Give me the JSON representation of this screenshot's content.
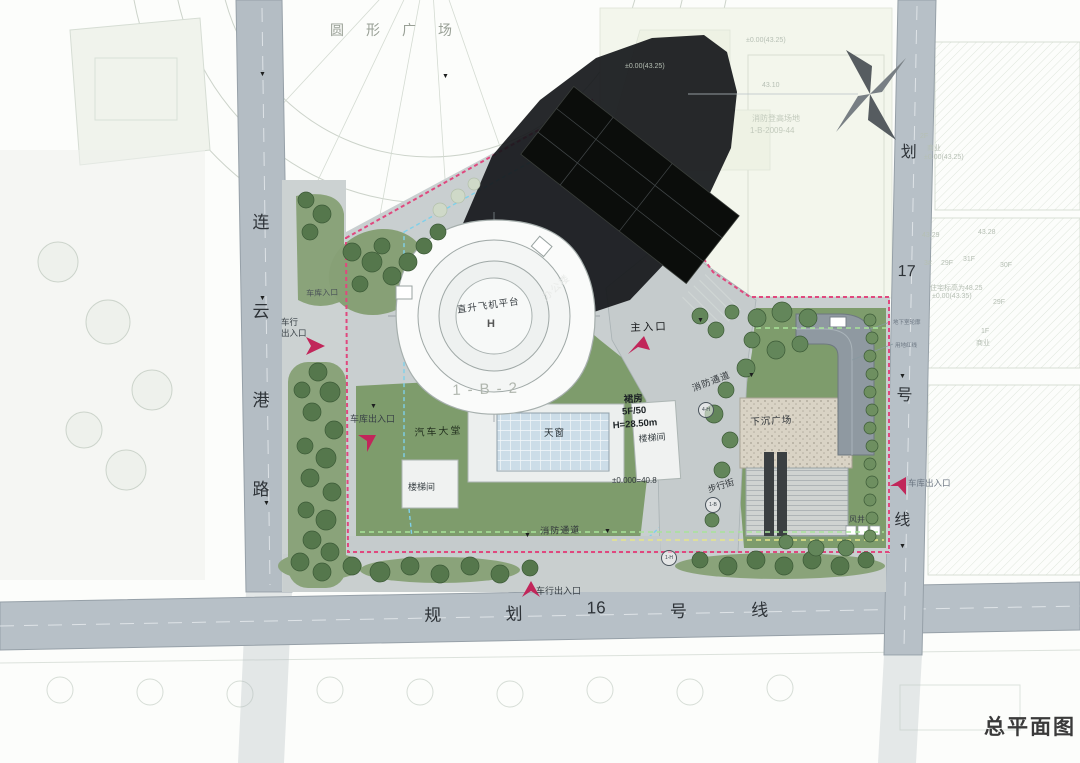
{
  "title": "总平面图",
  "roads": {
    "left": {
      "name": "连云港路",
      "chars": [
        "连",
        "云",
        "港",
        "路"
      ]
    },
    "bottom": {
      "name": "规划16号线",
      "chars": [
        "规",
        "划",
        "16",
        "号",
        "线"
      ]
    },
    "right": {
      "name": "规划17号线",
      "chars": [
        "划",
        "17",
        "号",
        "线"
      ]
    }
  },
  "plaza_label": "圆形广场",
  "building": {
    "helipad": "直升飞机平台",
    "helipad_mark": "H",
    "office": "办公楼",
    "podium": {
      "line1": "裙房",
      "line2": "5F/50",
      "line3": "H=28.50m"
    },
    "parcel_id": "1-B-2",
    "elevation": "±0.000=40.8",
    "skylight": "天窗",
    "car_lobby": "汽车大堂",
    "stair_a": "楼梯间",
    "stair_b": "楼梯间"
  },
  "entrances": {
    "main": "主入口",
    "garage_west": "车库出入口",
    "garage_top": "车库入口",
    "vehicle_west_1": "车行",
    "vehicle_west_2": "出入口",
    "vehicle_south": "车行出入口",
    "garage_east": "车库出入口"
  },
  "site": {
    "fire_lane_1": "消防通道",
    "fire_lane_2": "消防通道",
    "sunken_plaza": "下沉广场",
    "pedestrian_street": "步行街",
    "wind_shaft": "风井",
    "note_basement": "地下室轮廓",
    "note_redline": "用地红线"
  },
  "markers": {
    "m1": "4-H",
    "m2": "1-B",
    "m3": "1-H"
  },
  "context": {
    "elev_a": "±0.00(43.25)",
    "elev_b": "±0.00(43.25)",
    "spot_a": "43.10",
    "fire_site": "消防登高场地",
    "parcel_ref": "1-B-2009-44",
    "biz_floor": "2F",
    "biz_a": "商业",
    "elev_c": "±0.00(43.25)",
    "spot_b": "43.29",
    "spot_c": "43.28",
    "blk": "3#",
    "f29a": "29F",
    "f31": "31F",
    "f30": "30F",
    "res_note": "住宅标高为48.25",
    "elev_d": "±0.00(43.35)",
    "f29b": "29F",
    "f1": "1F",
    "biz_b": "商业"
  },
  "colors": {
    "boundary_red": "#e0487e",
    "basement_cyan": "#7fd0ea",
    "setback_green": "#a8e39a",
    "lawn": "#7e9c6c",
    "road": "#b7c0c7",
    "shadow": "#15171a",
    "arrow_red": "#c1265a"
  }
}
